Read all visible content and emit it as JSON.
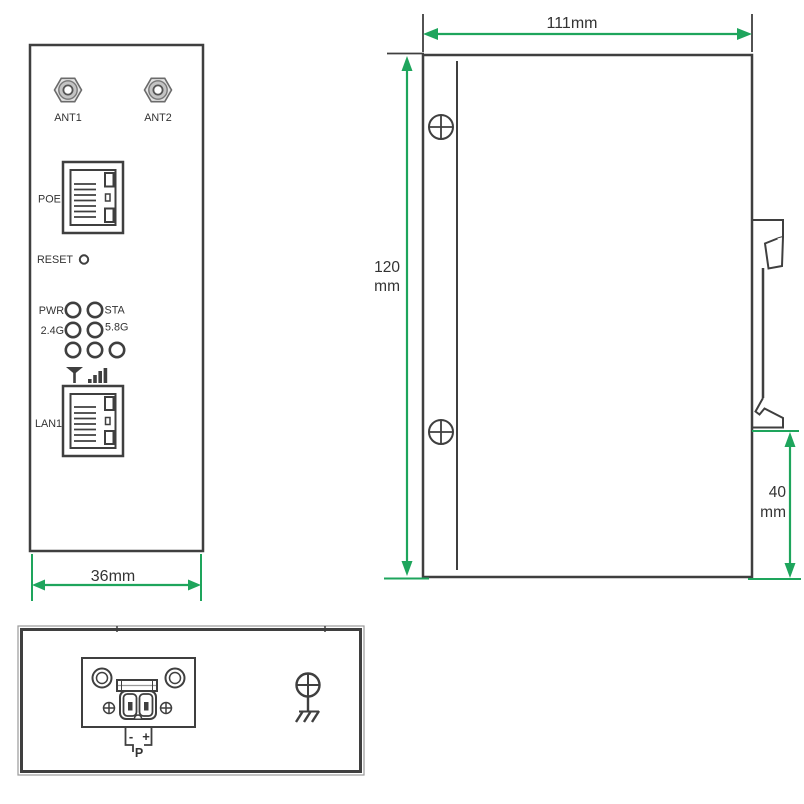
{
  "colors": {
    "outline": "#3f3f3f",
    "dimension": "#1ea55c",
    "text": "#333333",
    "connector_fill": "#c9c9c9",
    "background": "#ffffff"
  },
  "icons": {
    "antenna_connector": "hex-nut-coax",
    "reset_button": "small-circle",
    "led_indicator": "circle-outline",
    "antenna": "filled-triangle-with-stem",
    "signal_strength": "ascending-bars",
    "rj45_port": "ethernet-jack-outline",
    "screw": "crosshair-circle",
    "ground": "earth-ground-symbol",
    "terminal_block": "2-pin-screw-terminal",
    "dimension_arrow": "double-headed-arrow"
  },
  "front_view": {
    "antenna_labels": [
      "ANT1",
      "ANT2"
    ],
    "poe_label": "POE",
    "reset_label": "RESET",
    "led_labels": {
      "pwr": "PWR",
      "sta": "STA",
      "band24": "2.4G",
      "band58": "5.8G"
    },
    "lan_label": "LAN1",
    "width_dimension": "36mm"
  },
  "side_view": {
    "width_dimension": "111mm",
    "height_dimension_value": "120",
    "height_dimension_unit": "mm",
    "din_offset_value": "40",
    "din_offset_unit": "mm"
  },
  "bottom_view": {
    "polarity_negative": "-",
    "polarity_positive": "+",
    "power_label": "P"
  }
}
